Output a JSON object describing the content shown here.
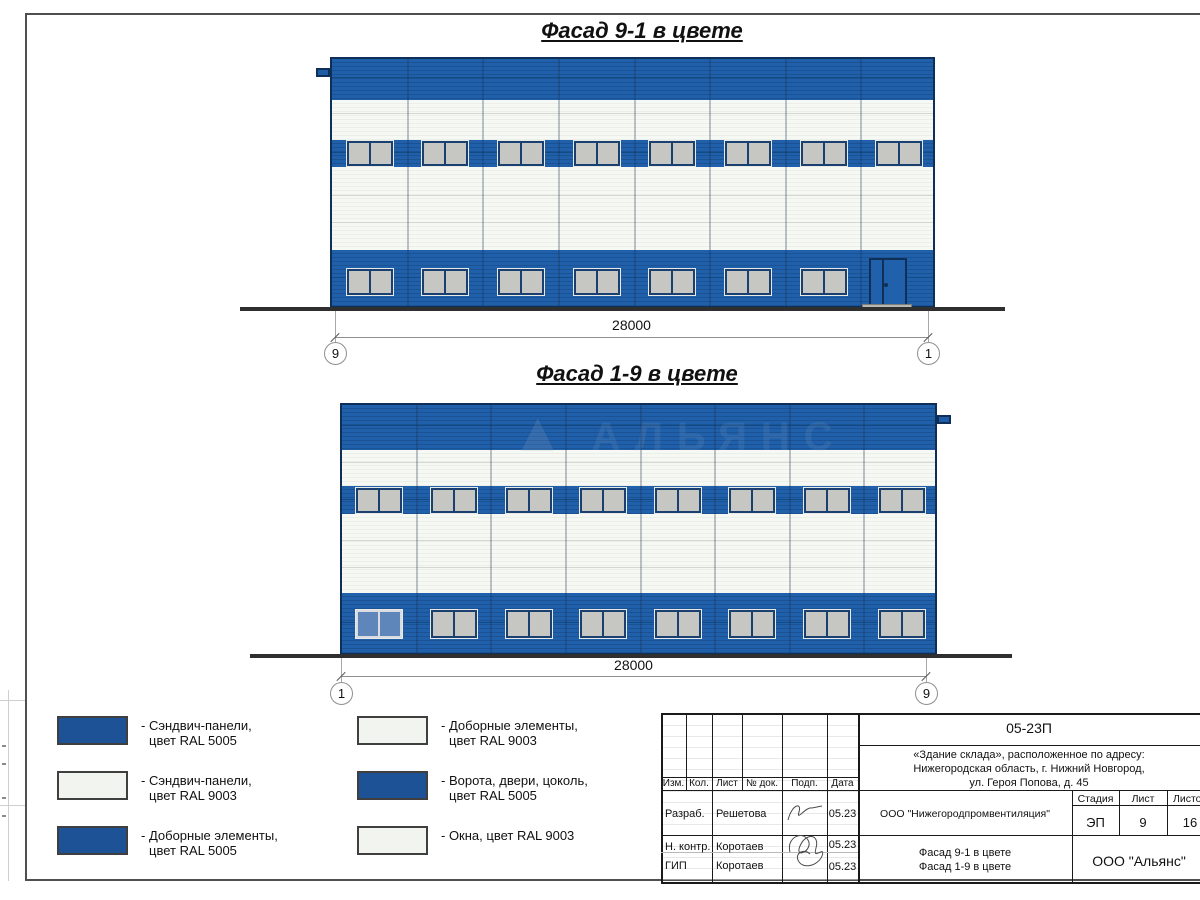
{
  "facades": [
    {
      "title": "Фасад 9-1 в цвете",
      "dimension": "28000",
      "axis_left": "9",
      "axis_right": "1",
      "top_windows": 8,
      "bottom_windows": 7,
      "has_door": true,
      "special_first_window": false
    },
    {
      "title": "Фасад 1-9 в цвете",
      "dimension": "28000",
      "axis_left": "1",
      "axis_right": "9",
      "top_windows": 8,
      "bottom_windows": 8,
      "has_door": false,
      "special_first_window": true
    }
  ],
  "watermark": "АЛЬЯНС",
  "legend": {
    "items": [
      {
        "line1": "- Сэндвич-панели,",
        "line2": "цвет RAL 5005",
        "color_key": "blue"
      },
      {
        "line1": "- Сэндвич-панели,",
        "line2": "цвет RAL 9003",
        "color_key": "white"
      },
      {
        "line1": "- Доборные элементы,",
        "line2": "цвет RAL 5005",
        "color_key": "blue"
      },
      {
        "line1": "- Доборные элементы,",
        "line2": "цвет RAL 9003",
        "color_key": "white"
      },
      {
        "line1": "- Ворота, двери, цоколь,",
        "line2": "цвет RAL 5005",
        "color_key": "blue"
      },
      {
        "line1": "- Окна, цвет RAL 9003",
        "line2": "",
        "color_key": "white"
      }
    ]
  },
  "title_block": {
    "doc_number": "05-23П",
    "project_lines": [
      "«Здание склада», расположенное по адресу:",
      "Нижегородская область, г. Нижний Новгород,",
      "ул. Героя Попова, д. 45"
    ],
    "header_cols": [
      "Изм.",
      "Кол.",
      "Лист",
      "№ док.",
      "Подп.",
      "Дата"
    ],
    "rows": [
      {
        "role": "Разраб.",
        "name": "Решетова",
        "date": "05.23"
      },
      {
        "role": "Н. контр.",
        "name": "Коротаев",
        "date": "05.23"
      },
      {
        "role": "ГИП",
        "name": "Коротаев",
        "date": "05.23"
      }
    ],
    "org": "ООО \"Нижегородпромвентиляция\"",
    "stage_label": "Стадия",
    "sheet_label": "Лист",
    "sheets_label": "Листов",
    "stage": "ЭП",
    "sheet_no": "9",
    "sheets_total": "16",
    "drawing_titles": [
      "Фасад 9-1 в цвете",
      "Фасад 1-9 в цвете"
    ],
    "company": "ООО \"Альянс\""
  },
  "colors": {
    "ral5005_blue": "#1d5296",
    "ral9003_white": "#f2f4ef",
    "window_glass": "#c6c6c3",
    "frame_navy": "#1a4071",
    "ground": "#2f2f2f"
  }
}
